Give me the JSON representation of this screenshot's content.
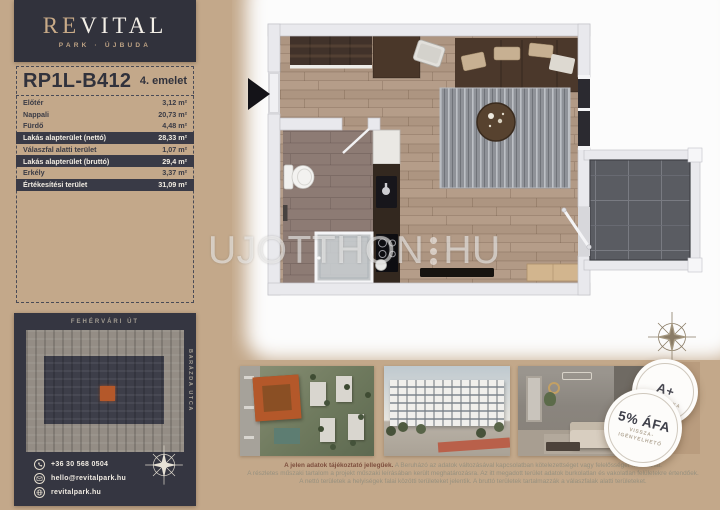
{
  "brand": {
    "logo_part1": "RE",
    "logo_part2": "VITAL",
    "subtitle": "PARK · ÚJBUDA"
  },
  "unit": {
    "code": "RP1L-B412",
    "floor": "4. emelet"
  },
  "area_table": {
    "rows": [
      {
        "label": "Előtér",
        "value": "3,12 m²"
      },
      {
        "label": "Nappali",
        "value": "20,73 m²"
      },
      {
        "label": "Fürdő",
        "value": "4,48 m²"
      },
      {
        "label": "Lakás alapterület (nettó)",
        "value": "28,33 m²"
      },
      {
        "label": "Válaszfal alatti terület",
        "value": "1,07 m²"
      },
      {
        "label": "Lakás alapterület (bruttó)",
        "value": "29,4 m²"
      },
      {
        "label": "Erkély",
        "value": "3,37 m²"
      },
      {
        "label": "Értékesítési terület",
        "value": "31,09 m²"
      }
    ]
  },
  "siteplan": {
    "street_top": "FEHÉRVÁRI ÚT",
    "street_right": "BARÁZDA UTCA"
  },
  "contact": {
    "phone": "+36 30 568 0504",
    "email": "hello@revitalpark.hu",
    "website": "revitalpark.hu"
  },
  "watermark": {
    "part1": "UJOTTHON",
    "part2": "HU"
  },
  "badges": {
    "energy": {
      "title": "A+",
      "subtitle": "ENERGETIKA"
    },
    "vat": {
      "title": "5% ÁFA",
      "line1": "VISSZA-",
      "line2": "IGÉNYELHETŐ"
    }
  },
  "disclaimer": {
    "lead": "A jelen adatok tájékoztató jellegűek.",
    "line1": "A Beruházó az adatok változásával kapcsolatban kötelezettséget vagy felelősséget nem vállal.",
    "line2": "A részletes műszaki tartalom a projekt műszaki leírásában került meghatározásra. Az itt megadott terület adatok burkolatlan és vakolatlan felületekre értendőek.",
    "line3": "A nettó területek a helyiségek falai közötti területeket jelentik. A bruttó területek tartalmazzák a válaszfalak alatti területeket."
  },
  "colors": {
    "background": "#c3a88a",
    "panel_dark": "#353641",
    "accent_orange": "#b4582a",
    "tan_panel": "#b99c7e",
    "disclaimer_lead": "#7e4f3e"
  }
}
